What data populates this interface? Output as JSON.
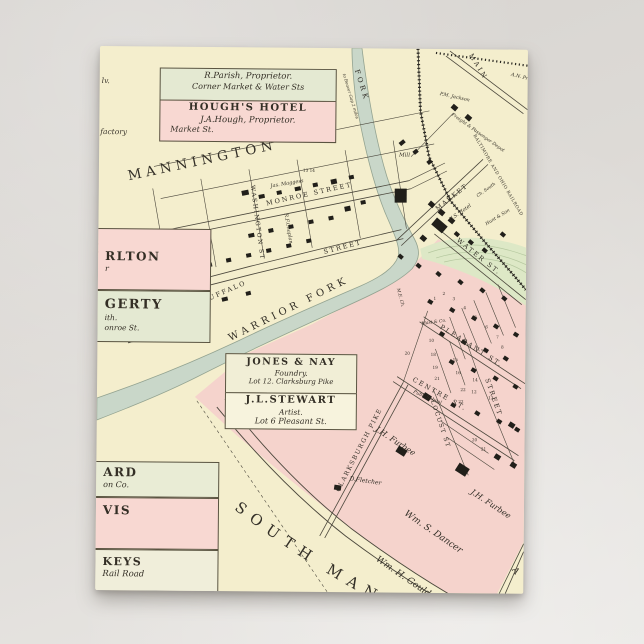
{
  "postcard": {
    "colors": {
      "paper": "#f4eecd",
      "pink": "#f5d3cc",
      "green_hill": "#dde8c6",
      "creek": "#c9d7c9",
      "ink": "#4b473c",
      "box_green": "#e4e9d2",
      "box_pink": "#f8d8d2",
      "box_cream": "#f1eed6"
    },
    "big_labels": {
      "mannington": "MANNINGTON",
      "south_main": "SOUTH MAN",
      "edge_a": "A"
    },
    "info_boxes": {
      "parish": {
        "line1": "R.Parish, Proprietor.",
        "line2": "Corner Market & Water Sts"
      },
      "hough": {
        "title": "HOUGH'S HOTEL",
        "line1": "J.A.Hough, Proprietor.",
        "line2": "Market St."
      },
      "jones": {
        "title": "JONES & NAY",
        "line1": "Foundry.",
        "line2": "Lot 12. Clarksburg Pike"
      },
      "stewart": {
        "title": "J.L.STEWART",
        "line1": "Artist.",
        "line2": "Lot 6 Pleasant St."
      },
      "carlton": {
        "title": "RLTON",
        "line1": "r"
      },
      "hagerty": {
        "title": "GERTY",
        "line1": "ith.",
        "line2": "onroe St."
      },
      "ard": {
        "title": "ARD",
        "line1": "on Co."
      },
      "vis": {
        "title": "VIS"
      },
      "keys": {
        "title": "KEYS",
        "line1": "Rail Road"
      },
      "edge_left_1": "lv.",
      "edge_left_2": "factory"
    },
    "streets": {
      "washington": "WASHINGTON ST",
      "monroe": "MONROE STREET",
      "street_upper": "STREET",
      "buffalo": "BUFFALO",
      "warrior_fork": "WARRIOR FORK",
      "fork": "FORK",
      "main": "MAIN",
      "market": "MARKET",
      "water": "WATER ST.",
      "pleasant": "PLEASANT ST.",
      "centre": "CENTRE ST.",
      "locust": "LOCUST ST",
      "street_vertical": "STREET",
      "clarksburgh": "CLARKSBURGH PIKE",
      "railroad": "BALTIMORE AND OHIO RAILROAD"
    },
    "names": {
      "jas_maggess": "Jas. Maggess",
      "rf_chaplan": "R.F.Chaplan",
      "nums_13_14": "13 14",
      "acreage_360": "360",
      "mill": "Mill",
      "beaver_gap": "to Beaver Gap 2 miles",
      "us_hotel": "U.S. Hotel",
      "ch_south": "Ch. South",
      "hunt_son": "Hunt & Son",
      "depot": "Freight & Passenger Depot",
      "pm_jackson": "P.M. Jackson",
      "an_prich": "A.N. Prich.",
      "me_ch": "M.E. Ch.",
      "mast_co": "Mast & Co.",
      "publ_school": "Publ. School",
      "jh_furbee": "J.H. Furbee",
      "d_fletcher": "D.Fletcher",
      "wm_s_dancer": "Wm. S. Dancer",
      "wm_h_gould": "Wm. H. Gould"
    },
    "lot_numbers": [
      "1",
      "2",
      "3",
      "4",
      "5",
      "6",
      "7",
      "8",
      "10",
      "18",
      "19",
      "20",
      "21",
      "22",
      "15",
      "16",
      "14",
      "13",
      "12",
      "20",
      "21",
      "22"
    ]
  }
}
